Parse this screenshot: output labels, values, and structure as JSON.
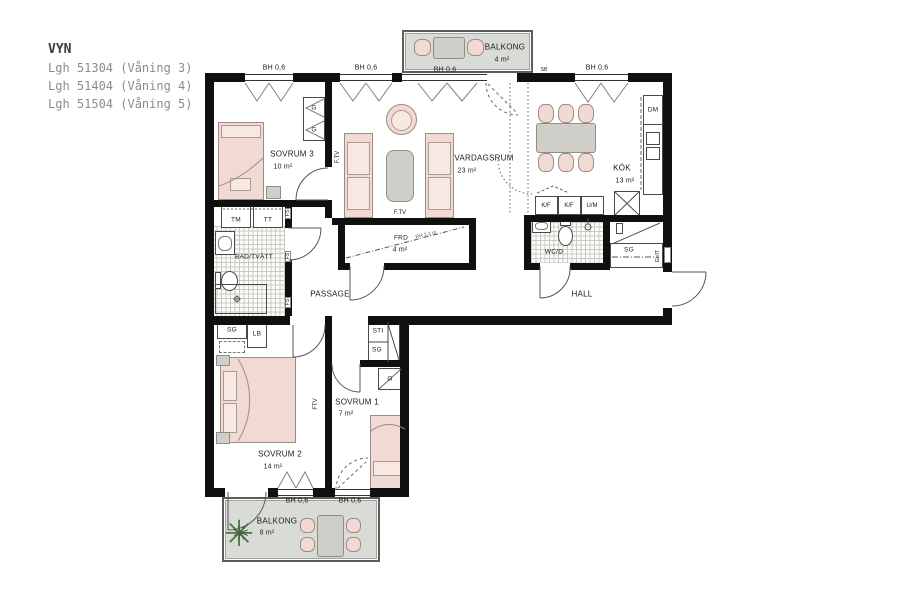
{
  "header": {
    "title": "VYN",
    "apartments": [
      "Lgh 51304 (Våning 3)",
      "Lgh 51404 (Våning 4)",
      "Lgh 51504 (Våning 5)"
    ]
  },
  "rooms": {
    "sovrum3": {
      "name": "SOVRUM 3",
      "area": "10 m²"
    },
    "vardagsrum": {
      "name": "VARDAGSRUM",
      "area": "23 m²"
    },
    "kok": {
      "name": "KÖK",
      "area": "13 m²"
    },
    "bad": {
      "name": "BAD/TVÄTT"
    },
    "frd": {
      "name": "FRD",
      "area": "4 m²",
      "ceiling_note": "RH 2,2 m"
    },
    "passage": {
      "name": "PASSAGE"
    },
    "wcd": {
      "name": "WC/D"
    },
    "hall": {
      "name": "HALL"
    },
    "sovrum2": {
      "name": "SOVRUM 2",
      "area": "14 m²"
    },
    "sovrum1": {
      "name": "SOVRUM 1",
      "area": "7 m²"
    },
    "balkong_top": {
      "name": "BALKONG",
      "area": "4 m²"
    },
    "balkong_bottom": {
      "name": "BALKONG",
      "area": "8 m²"
    }
  },
  "labels": {
    "window_height": "BH 0,6",
    "wardrobe": "G",
    "cleaning_closet": "SG",
    "linen_closet": "LB",
    "shaft": "STI",
    "washer": "TM",
    "dryer": "TT",
    "dishwasher": "DM",
    "fridge_freezer": "K/F",
    "oven_micro": "U/M",
    "electrical": "EL/IT",
    "tv_outlet": "F.TV",
    "tv_outlet_short": "FTV",
    "wall_mark": "FS",
    "wall_mark_sb": "SB"
  }
}
